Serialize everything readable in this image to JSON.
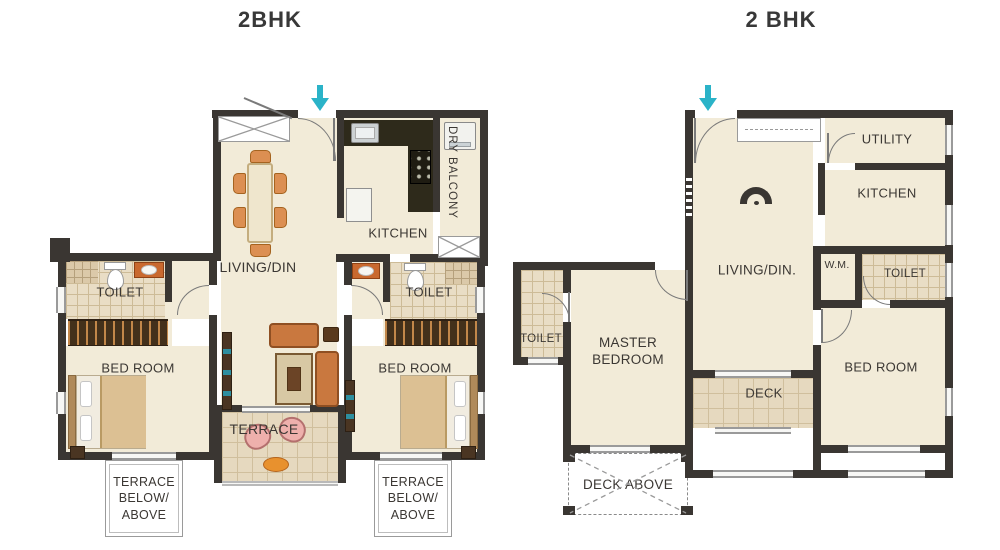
{
  "page": {
    "background": "#ffffff"
  },
  "colors": {
    "wall": "#3a3632",
    "floor": "#f2ebd8",
    "tile": "#e9ddc5",
    "accent_teal": "#2bb3c8",
    "text": "#3b3733",
    "furniture_orange": "#d98a4d",
    "furniture_brown": "#4a3522"
  },
  "plans": [
    {
      "title": "2BHK",
      "labels": {
        "living": "LIVING/DIN",
        "kitchen": "KITCHEN",
        "dry_balcony": "DRY BALCONY",
        "toilet_left": "TOILET",
        "toilet_right": "TOILET",
        "bedroom_left": "BED ROOM",
        "bedroom_right": "BED ROOM",
        "terrace": "TERRACE",
        "terrace_note_left": "TERRACE BELOW/ ABOVE",
        "terrace_note_right": "TERRACE BELOW/ ABOVE"
      }
    },
    {
      "title": "2 BHK",
      "labels": {
        "living": "LIVING/DIN.",
        "utility": "UTILITY",
        "kitchen": "KITCHEN",
        "wm": "W.M.",
        "toilet_left": "TOILET",
        "toilet_right": "TOILET",
        "master_bedroom": "MASTER BEDROOM",
        "bedroom": "BED ROOM",
        "deck": "DECK",
        "deck_above": "DECK ABOVE"
      }
    }
  ]
}
